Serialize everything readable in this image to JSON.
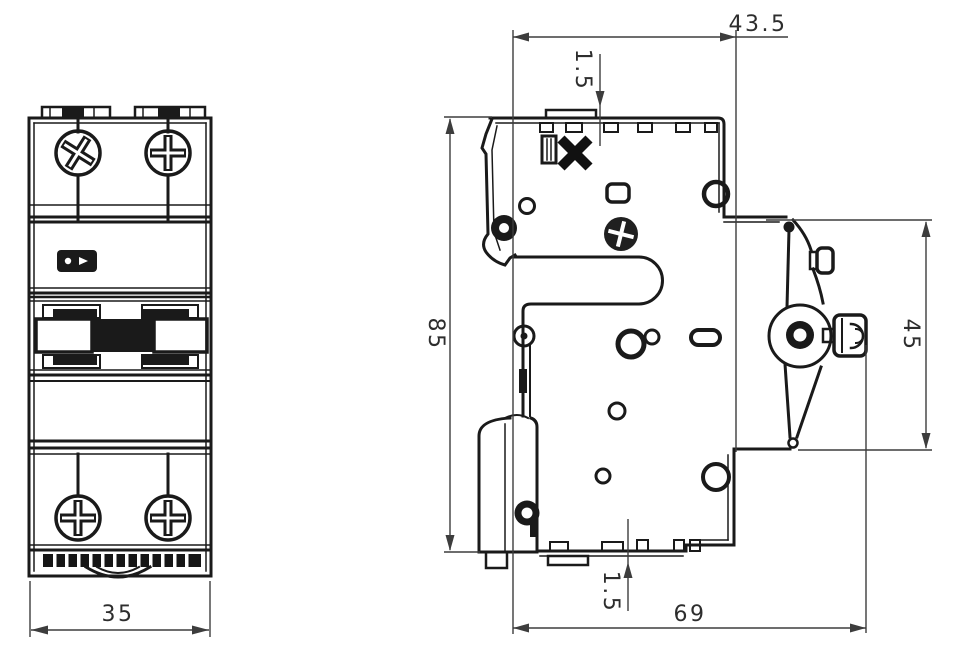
{
  "drawing": {
    "description": "Two-view technical dimension drawing of a DIN-rail miniature circuit breaker (front view and side profile view)",
    "line_color": "#1a1a1a",
    "dimension_line_color": "#3d3d3d",
    "background_color": "#ffffff",
    "dimensions": {
      "front_width": "35",
      "top_width": "43.5",
      "top_rib_height": "1.5",
      "body_height": "85",
      "terminal_side_height": "45",
      "bottom_depth": "69",
      "bottom_rib_height": "1.5"
    }
  }
}
